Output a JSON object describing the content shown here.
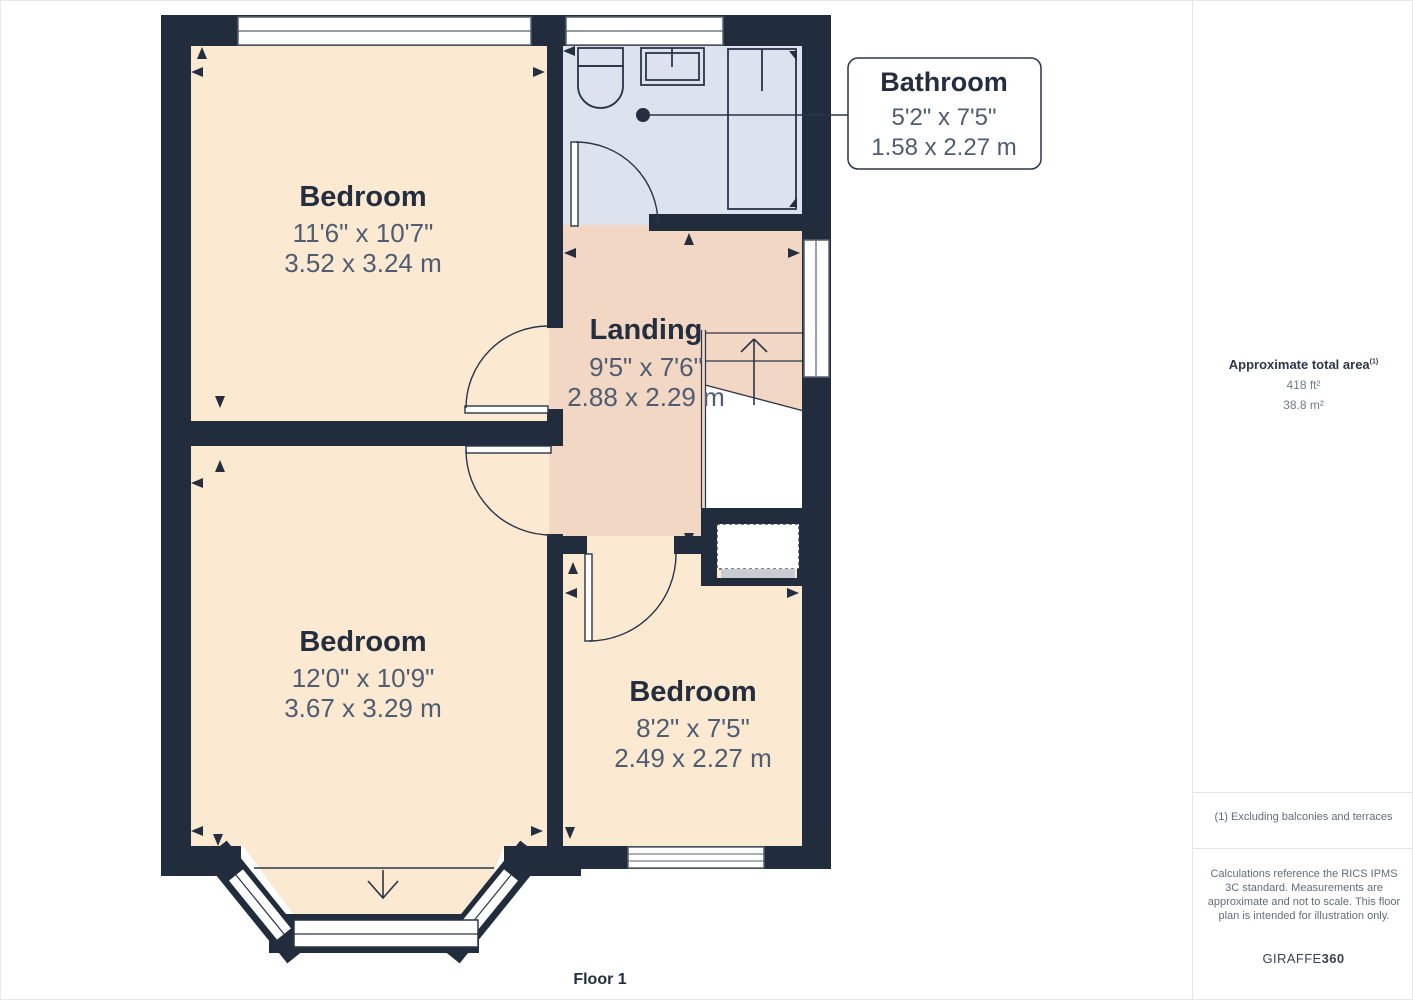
{
  "floorplan": {
    "floor_label": "Floor 1",
    "rooms": [
      {
        "id": "bedroom-top-left",
        "name": "Bedroom",
        "imperial": "11'6\" x 10'7\"",
        "metric": "3.52 x 3.24 m"
      },
      {
        "id": "landing",
        "name": "Landing",
        "imperial": "9'5\" x 7'6\"",
        "metric": "2.88 x 2.29 m"
      },
      {
        "id": "bedroom-bottom-left",
        "name": "Bedroom",
        "imperial": "12'0\" x 10'9\"",
        "metric": "3.67 x 3.29 m"
      },
      {
        "id": "bedroom-bottom-right",
        "name": "Bedroom",
        "imperial": "8'2\" x 7'5\"",
        "metric": "2.49 x 2.27 m"
      }
    ],
    "callout": {
      "name": "Bathroom",
      "imperial": "5'2\" x 7'5\"",
      "metric": "1.58 x 2.27 m"
    }
  },
  "sidebar": {
    "area_title": "Approximate total area",
    "area_footnote_marker": "(1)",
    "area_ft": "418 ft²",
    "area_m": "38.8 m²",
    "footnote": "(1) Excluding balconies and terraces",
    "disclaimer": "Calculations reference the RICS IPMS 3C standard. Measurements are approximate and not to scale. This floor plan is intended for illustration only.",
    "brand_name": "GIRAFFE",
    "brand_suffix": "360"
  },
  "colors": {
    "wall": "#212c3c",
    "bedroom_floor": "#fbe9d2",
    "landing_floor": "#f1d7c4",
    "bathroom_floor": "#dde3ee"
  }
}
